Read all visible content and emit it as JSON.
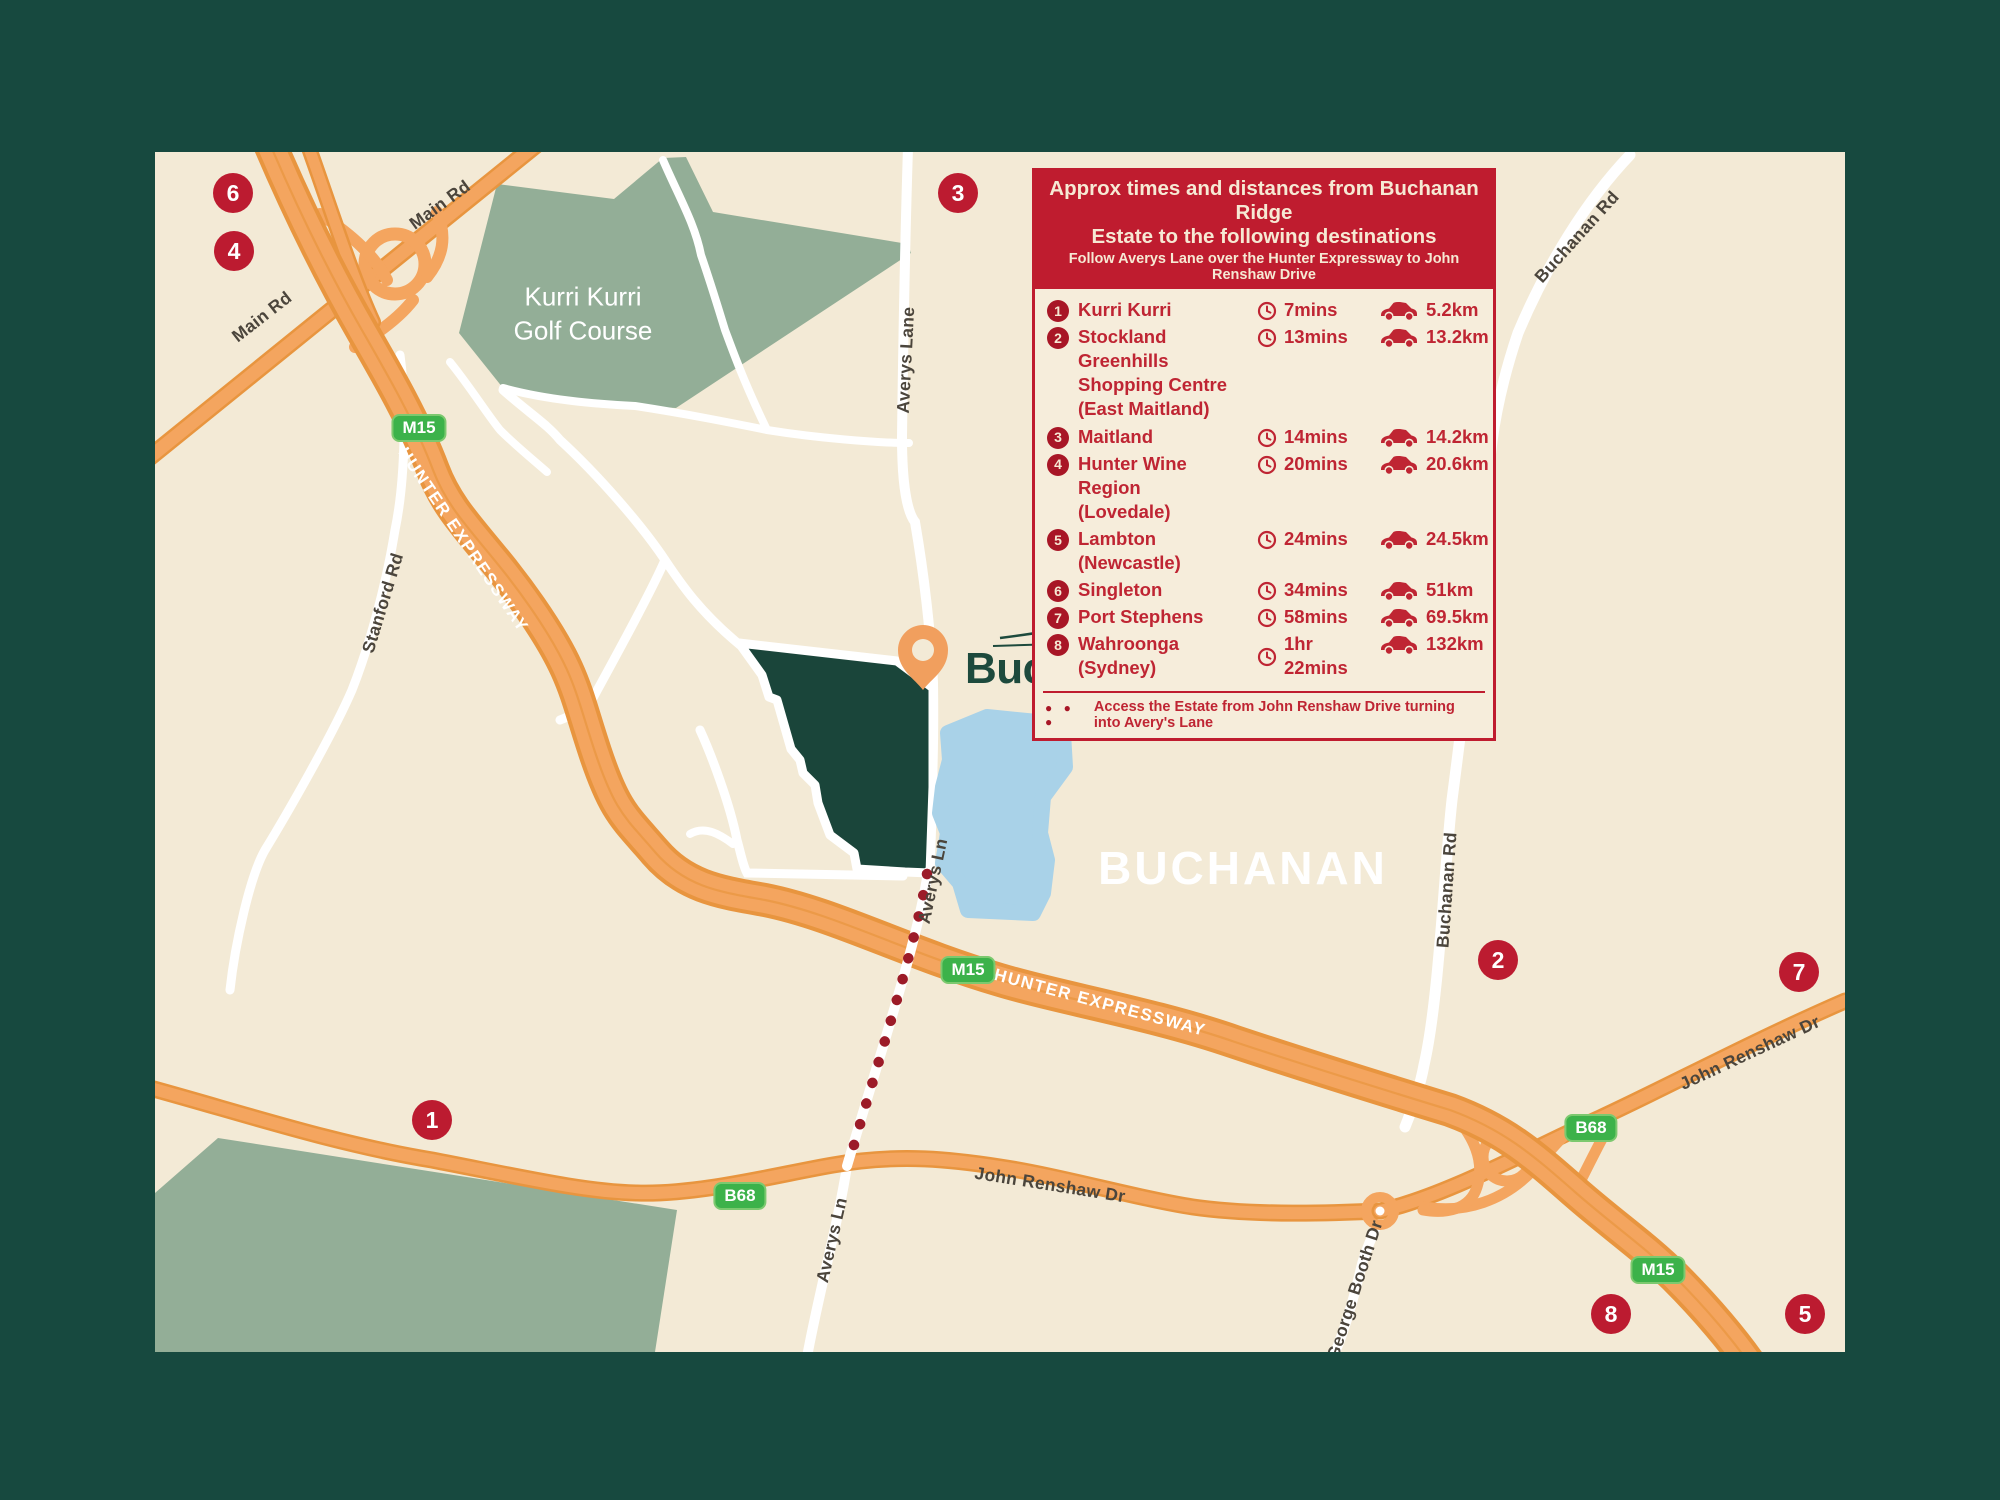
{
  "colors": {
    "frame-green": "#17493f",
    "map-bg": "#f3ead6",
    "area-green": "#93ae97",
    "estate-green": "#1a453a",
    "road-orange": "#f4a55f",
    "road-casing": "#e8953f",
    "lake-blue": "#a9d2e8",
    "marker-red": "#bc1b30",
    "badge-red": "#a81626",
    "shield-green": "#3cb24a",
    "legend-red": "#bf1c2f",
    "legend-bg": "#f6eddb",
    "text-red": "#bf2533",
    "label-dark": "#4b453c",
    "cream-text": "#f6e9d4",
    "logo-dark": "#1d4a3d",
    "logo-sage": "#9cbaa1",
    "dots-red": "#9c1b28",
    "pin-orange": "#f19f5e"
  },
  "map": {
    "region_label": "BUCHANAN",
    "golf_course_label": "Kurri Kurri\nGolf Course",
    "logo": {
      "primary": "Buchanan",
      "secondary": "Ridge"
    },
    "markers": [
      {
        "number": "6"
      },
      {
        "number": "4"
      },
      {
        "number": "3"
      },
      {
        "number": "1"
      },
      {
        "number": "2"
      },
      {
        "number": "7"
      },
      {
        "number": "8"
      },
      {
        "number": "5"
      }
    ],
    "shields": [
      {
        "label": "M15"
      },
      {
        "label": "M15"
      },
      {
        "label": "M15"
      },
      {
        "label": "B68"
      },
      {
        "label": "B68"
      }
    ],
    "road_labels": [
      {
        "text": "Main Rd"
      },
      {
        "text": "Main Rd"
      },
      {
        "text": "Stanford Rd"
      },
      {
        "text": "Averys Lane"
      },
      {
        "text": "Averys Ln"
      },
      {
        "text": "Averys Ln"
      },
      {
        "text": "HUNTER EXPRESSWAY"
      },
      {
        "text": "HUNTER EXPRESSWAY"
      },
      {
        "text": "John Renshaw Dr"
      },
      {
        "text": "John Renshaw Dr"
      },
      {
        "text": "George Booth Dr"
      },
      {
        "text": "Buchanan Rd"
      },
      {
        "text": "Buchanan Rd"
      }
    ]
  },
  "legend": {
    "title": "Approx times and distances from Buchanan Ridge\nEstate to the following destinations",
    "subtitle": "Follow Averys Lane over the Hunter Expressway to John Renshaw Drive",
    "rows": [
      {
        "num": "1",
        "name": "Kurri Kurri",
        "time": "7mins",
        "distance": "5.2km"
      },
      {
        "num": "2",
        "name": "Stockland Greenhills\nShopping Centre\n(East Maitland)",
        "time": "13mins",
        "distance": "13.2km"
      },
      {
        "num": "3",
        "name": "Maitland",
        "time": "14mins",
        "distance": "14.2km"
      },
      {
        "num": "4",
        "name": "Hunter Wine Region\n(Lovedale)",
        "time": "20mins",
        "distance": "20.6km"
      },
      {
        "num": "5",
        "name": "Lambton (Newcastle)",
        "time": "24mins",
        "distance": "24.5km"
      },
      {
        "num": "6",
        "name": "Singleton",
        "time": "34mins",
        "distance": "51km"
      },
      {
        "num": "7",
        "name": "Port Stephens",
        "time": "58mins",
        "distance": "69.5km"
      },
      {
        "num": "8",
        "name": "Wahroonga (Sydney)",
        "time": "1hr 22mins",
        "distance": "132km"
      }
    ],
    "footer_dots": "● ● ●",
    "footer_note": "Access the Estate from John Renshaw Drive turning into Avery's Lane"
  }
}
